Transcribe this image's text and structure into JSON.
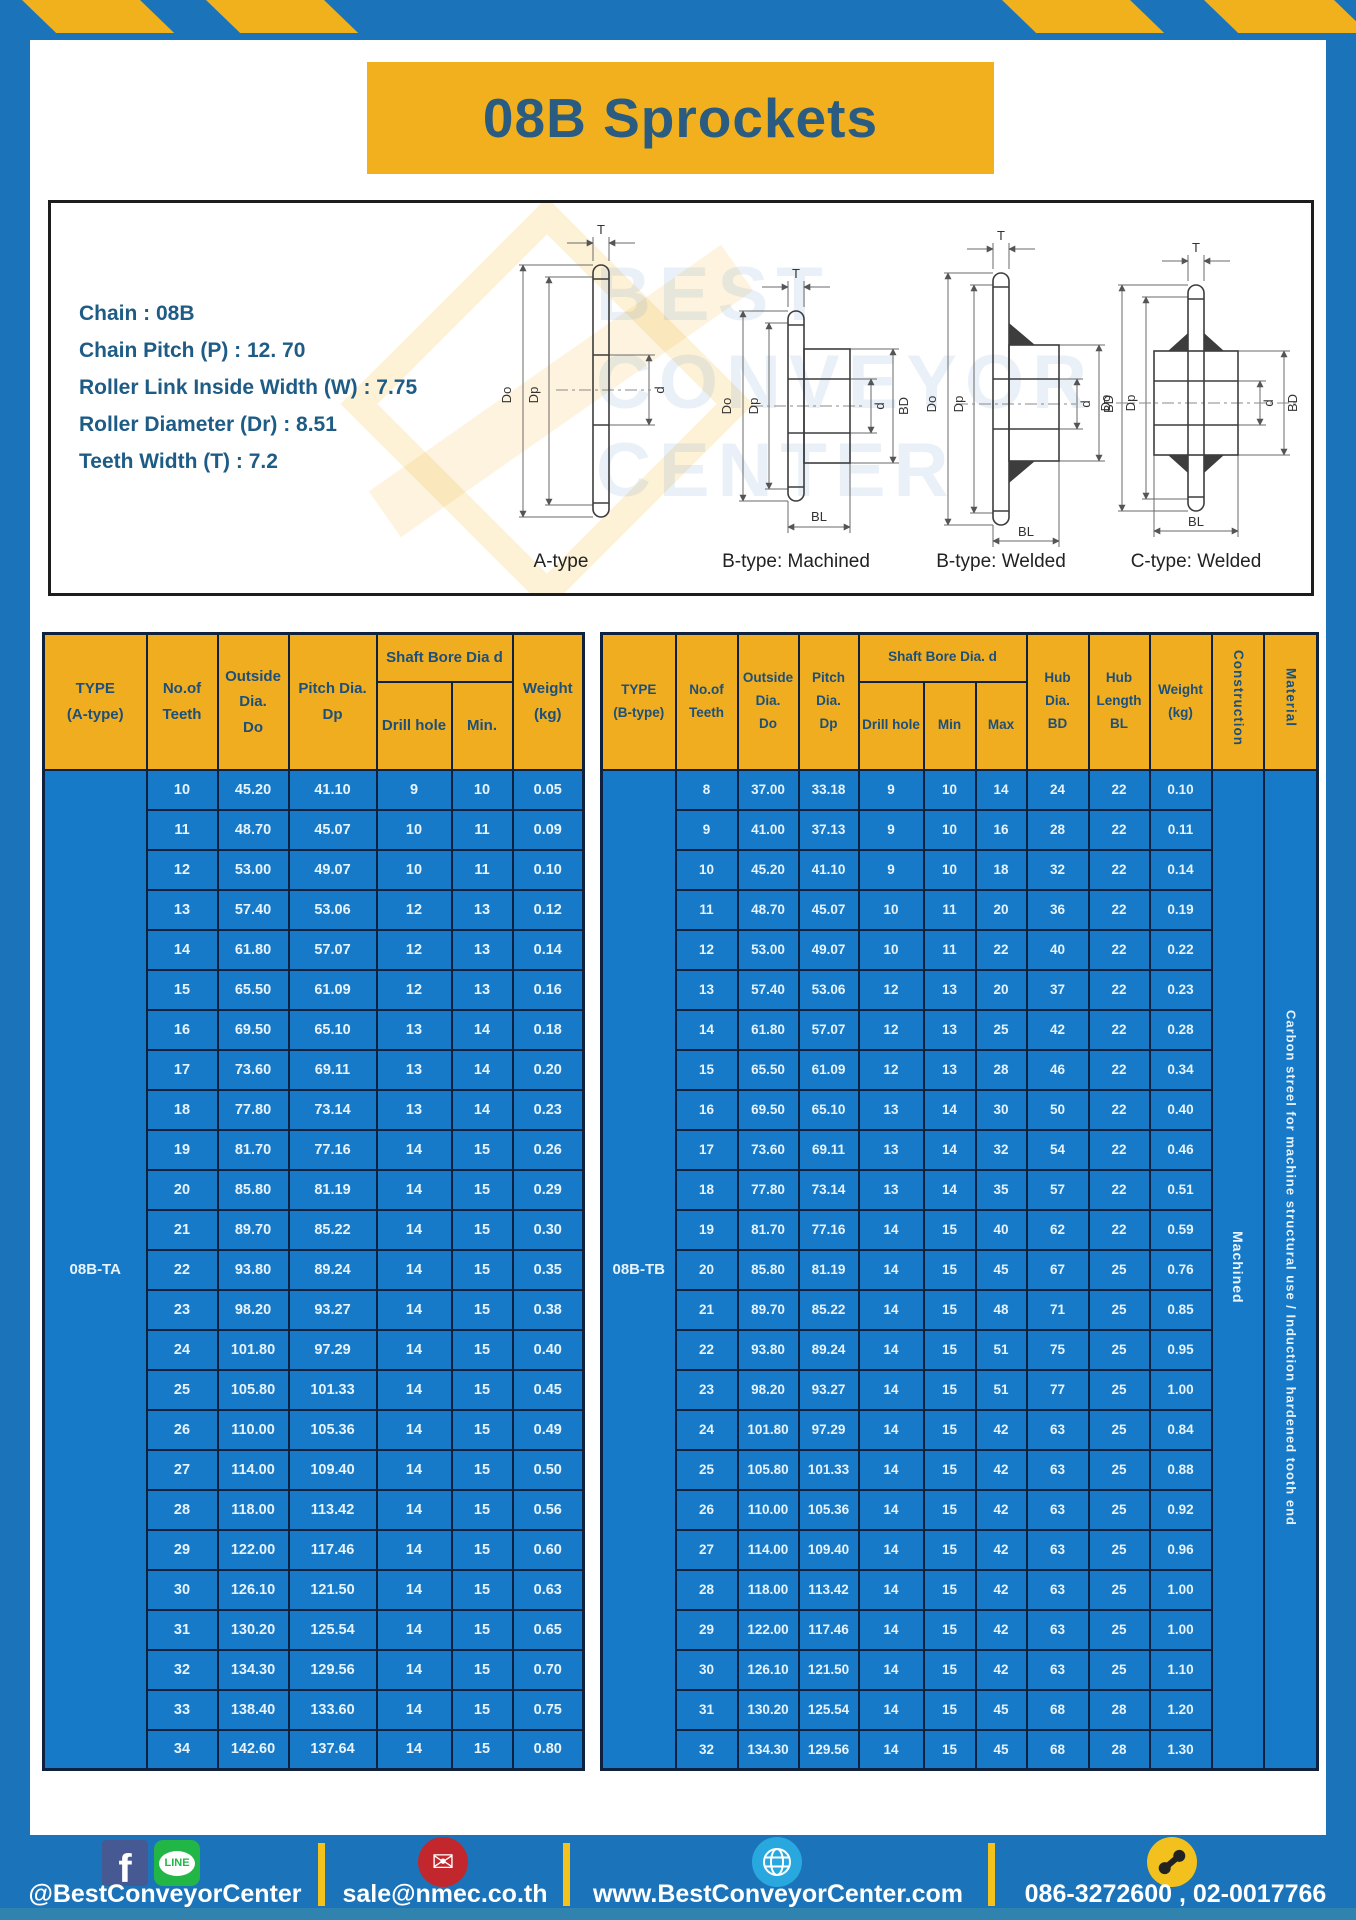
{
  "page": {
    "title": "08B Sprockets"
  },
  "specs": {
    "lines": [
      "Chain : 08B",
      "Chain Pitch (P) : 12. 70",
      "Roller Link Inside Width (W) : 7.75",
      "Roller Diameter (Dr) : 8.51",
      "Teeth Width (T) : 7.2"
    ]
  },
  "diagrams": {
    "labels": [
      "A-type",
      "B-type: Machined",
      "B-type: Welded",
      "C-type: Welded"
    ],
    "dims": {
      "t": "T",
      "outer": "Do",
      "pitch": "Dp",
      "bore": "d",
      "hub": "BD",
      "hub_len": "BL"
    },
    "watermark": [
      "BEST",
      "CONVEYOR",
      "CENTER"
    ]
  },
  "tables": {
    "left": {
      "type_label": "08B-TA",
      "header": {
        "type": "TYPE\n(A-type)",
        "teeth": "No.of\nTeeth",
        "outside": "Outside\nDia.\nDo",
        "pitch": "Pitch Dia.\nDp",
        "shaft_bore": "Shaft Bore Dia d",
        "drill": "Drill hole",
        "min": "Min.",
        "weight": "Weight\n(kg)"
      },
      "rows": [
        [
          "10",
          "45.20",
          "41.10",
          "9",
          "10",
          "0.05"
        ],
        [
          "11",
          "48.70",
          "45.07",
          "10",
          "11",
          "0.09"
        ],
        [
          "12",
          "53.00",
          "49.07",
          "10",
          "11",
          "0.10"
        ],
        [
          "13",
          "57.40",
          "53.06",
          "12",
          "13",
          "0.12"
        ],
        [
          "14",
          "61.80",
          "57.07",
          "12",
          "13",
          "0.14"
        ],
        [
          "15",
          "65.50",
          "61.09",
          "12",
          "13",
          "0.16"
        ],
        [
          "16",
          "69.50",
          "65.10",
          "13",
          "14",
          "0.18"
        ],
        [
          "17",
          "73.60",
          "69.11",
          "13",
          "14",
          "0.20"
        ],
        [
          "18",
          "77.80",
          "73.14",
          "13",
          "14",
          "0.23"
        ],
        [
          "19",
          "81.70",
          "77.16",
          "14",
          "15",
          "0.26"
        ],
        [
          "20",
          "85.80",
          "81.19",
          "14",
          "15",
          "0.29"
        ],
        [
          "21",
          "89.70",
          "85.22",
          "14",
          "15",
          "0.30"
        ],
        [
          "22",
          "93.80",
          "89.24",
          "14",
          "15",
          "0.35"
        ],
        [
          "23",
          "98.20",
          "93.27",
          "14",
          "15",
          "0.38"
        ],
        [
          "24",
          "101.80",
          "97.29",
          "14",
          "15",
          "0.40"
        ],
        [
          "25",
          "105.80",
          "101.33",
          "14",
          "15",
          "0.45"
        ],
        [
          "26",
          "110.00",
          "105.36",
          "14",
          "15",
          "0.49"
        ],
        [
          "27",
          "114.00",
          "109.40",
          "14",
          "15",
          "0.50"
        ],
        [
          "28",
          "118.00",
          "113.42",
          "14",
          "15",
          "0.56"
        ],
        [
          "29",
          "122.00",
          "117.46",
          "14",
          "15",
          "0.60"
        ],
        [
          "30",
          "126.10",
          "121.50",
          "14",
          "15",
          "0.63"
        ],
        [
          "31",
          "130.20",
          "125.54",
          "14",
          "15",
          "0.65"
        ],
        [
          "32",
          "134.30",
          "129.56",
          "14",
          "15",
          "0.70"
        ],
        [
          "33",
          "138.40",
          "133.60",
          "14",
          "15",
          "0.75"
        ],
        [
          "34",
          "142.60",
          "137.64",
          "14",
          "15",
          "0.80"
        ]
      ]
    },
    "right": {
      "type_label": "08B-TB",
      "construction": "Machined",
      "material": "Carbon streel for machine structural use / Induction hardened tooth end",
      "header": {
        "type": "TYPE\n(B-type)",
        "teeth": "No.of\nTeeth",
        "outside": "Outside\nDia.\nDo",
        "pitch": "Pitch\nDia.\nDp",
        "shaft_bore": "Shaft Bore Dia. d",
        "drill": "Drill hole",
        "min": "Min",
        "max": "Max",
        "hub_dia": "Hub\nDia.\nBD",
        "hub_len": "Hub\nLength\nBL",
        "weight": "Weight\n(kg)",
        "construction": "Construction",
        "material": "Material"
      },
      "rows": [
        [
          "8",
          "37.00",
          "33.18",
          "9",
          "10",
          "14",
          "24",
          "22",
          "0.10"
        ],
        [
          "9",
          "41.00",
          "37.13",
          "9",
          "10",
          "16",
          "28",
          "22",
          "0.11"
        ],
        [
          "10",
          "45.20",
          "41.10",
          "9",
          "10",
          "18",
          "32",
          "22",
          "0.14"
        ],
        [
          "11",
          "48.70",
          "45.07",
          "10",
          "11",
          "20",
          "36",
          "22",
          "0.19"
        ],
        [
          "12",
          "53.00",
          "49.07",
          "10",
          "11",
          "22",
          "40",
          "22",
          "0.22"
        ],
        [
          "13",
          "57.40",
          "53.06",
          "12",
          "13",
          "20",
          "37",
          "22",
          "0.23"
        ],
        [
          "14",
          "61.80",
          "57.07",
          "12",
          "13",
          "25",
          "42",
          "22",
          "0.28"
        ],
        [
          "15",
          "65.50",
          "61.09",
          "12",
          "13",
          "28",
          "46",
          "22",
          "0.34"
        ],
        [
          "16",
          "69.50",
          "65.10",
          "13",
          "14",
          "30",
          "50",
          "22",
          "0.40"
        ],
        [
          "17",
          "73.60",
          "69.11",
          "13",
          "14",
          "32",
          "54",
          "22",
          "0.46"
        ],
        [
          "18",
          "77.80",
          "73.14",
          "13",
          "14",
          "35",
          "57",
          "22",
          "0.51"
        ],
        [
          "19",
          "81.70",
          "77.16",
          "14",
          "15",
          "40",
          "62",
          "22",
          "0.59"
        ],
        [
          "20",
          "85.80",
          "81.19",
          "14",
          "15",
          "45",
          "67",
          "25",
          "0.76"
        ],
        [
          "21",
          "89.70",
          "85.22",
          "14",
          "15",
          "48",
          "71",
          "25",
          "0.85"
        ],
        [
          "22",
          "93.80",
          "89.24",
          "14",
          "15",
          "51",
          "75",
          "25",
          "0.95"
        ],
        [
          "23",
          "98.20",
          "93.27",
          "14",
          "15",
          "51",
          "77",
          "25",
          "1.00"
        ],
        [
          "24",
          "101.80",
          "97.29",
          "14",
          "15",
          "42",
          "63",
          "25",
          "0.84"
        ],
        [
          "25",
          "105.80",
          "101.33",
          "14",
          "15",
          "42",
          "63",
          "25",
          "0.88"
        ],
        [
          "26",
          "110.00",
          "105.36",
          "14",
          "15",
          "42",
          "63",
          "25",
          "0.92"
        ],
        [
          "27",
          "114.00",
          "109.40",
          "14",
          "15",
          "42",
          "63",
          "25",
          "0.96"
        ],
        [
          "28",
          "118.00",
          "113.42",
          "14",
          "15",
          "42",
          "63",
          "25",
          "1.00"
        ],
        [
          "29",
          "122.00",
          "117.46",
          "14",
          "15",
          "42",
          "63",
          "25",
          "1.00"
        ],
        [
          "30",
          "126.10",
          "121.50",
          "14",
          "15",
          "42",
          "63",
          "25",
          "1.10"
        ],
        [
          "31",
          "130.20",
          "125.54",
          "14",
          "15",
          "45",
          "68",
          "28",
          "1.20"
        ],
        [
          "32",
          "134.30",
          "129.56",
          "14",
          "15",
          "45",
          "68",
          "28",
          "1.30"
        ]
      ]
    }
  },
  "footer": {
    "facebook_letter": "f",
    "line_label": "LINE",
    "social_handle": "@BestConveyorCenter",
    "email": "sale@nmec.co.th",
    "website": "www.BestConveyorCenter.com",
    "phones": "086-3272600 , 02-0017766"
  },
  "colors": {
    "frame_blue": "#1b74ba",
    "table_cell_blue": "#177ac9",
    "accent_yellow": "#f0ad1f",
    "border_navy": "#0e2240",
    "title_text_blue": "#2a5b80",
    "footer_strip_blue": "#2f83ae",
    "facebook_blue": "#475993",
    "line_green": "#21b646",
    "email_red": "#c1272d",
    "globe_blue": "#29a8e0",
    "phone_yellow": "#f2c11e"
  }
}
